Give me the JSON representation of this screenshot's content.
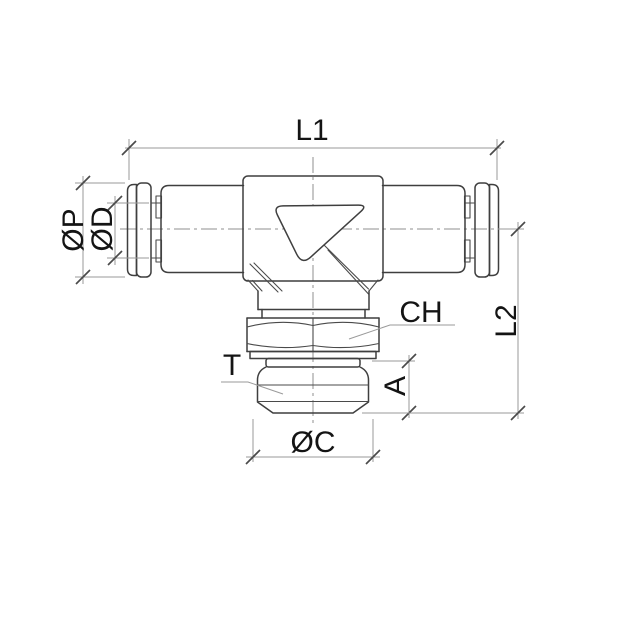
{
  "drawing": {
    "labels": {
      "l1": "L1",
      "op": "ØP",
      "od": "ØD",
      "ch": "CH",
      "t": "T",
      "a": "A",
      "oc": "ØC",
      "l2": "L2"
    },
    "colors": {
      "background": "#ffffff",
      "object_line": "#3f3f3f",
      "dimension_line": "#9a9a9a",
      "tick": "#4a4a4a",
      "text": "#141414"
    }
  }
}
